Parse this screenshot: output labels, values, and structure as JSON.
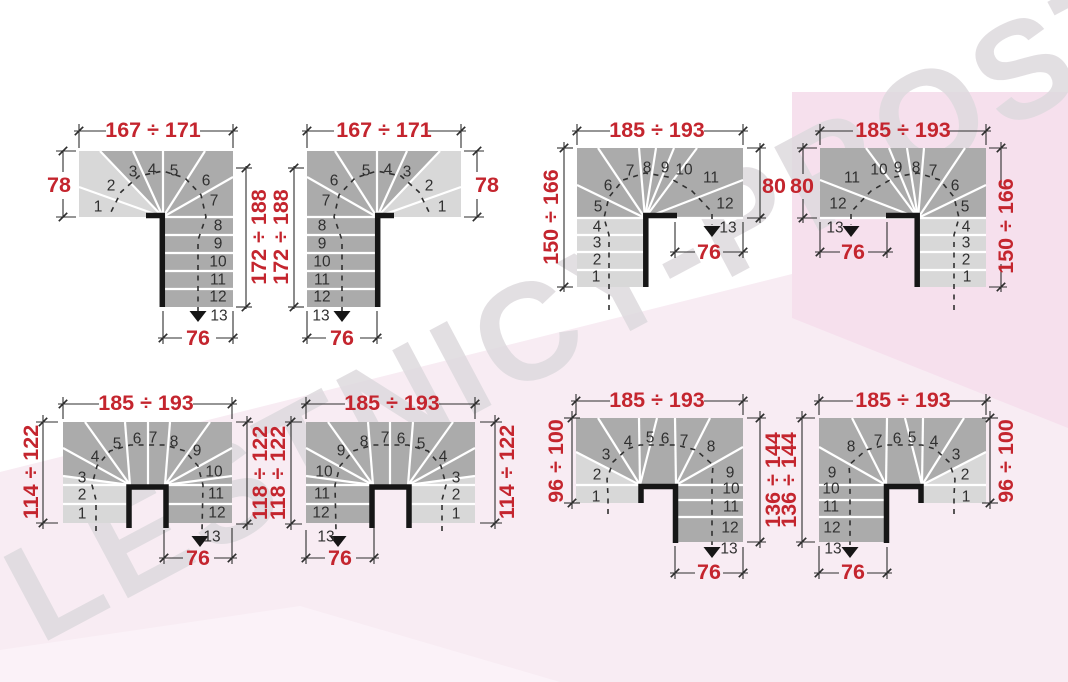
{
  "watermark": "LESTNICY-PROSTO.RU",
  "step_numbers": [
    "1",
    "2",
    "3",
    "4",
    "5",
    "6",
    "7",
    "8",
    "9",
    "10",
    "11",
    "12",
    "13"
  ],
  "diagrams": [
    {
      "name": "top-left-winder-left-turn",
      "dims": {
        "top": "167 ÷ 171",
        "left": "78",
        "right": "172 ÷ 188",
        "bottom": "76"
      }
    },
    {
      "name": "top-second-winder-right-turn",
      "dims": {
        "top": "167 ÷ 171",
        "left": "172 ÷ 188",
        "right": "78",
        "bottom": "76"
      }
    },
    {
      "name": "top-third-winder-up-right",
      "dims": {
        "top": "185 ÷ 193",
        "left": "150 ÷ 166",
        "right": "80",
        "bottom": "76"
      }
    },
    {
      "name": "top-fourth-winder-up-left",
      "dims": {
        "top": "185 ÷ 193",
        "left": "80",
        "right": "150 ÷ 166",
        "bottom": "76"
      }
    },
    {
      "name": "bottom-left-u-turn",
      "dims": {
        "top": "185 ÷ 193",
        "left": "114 ÷ 122",
        "right": "118 ÷ 122",
        "bottom": "76"
      }
    },
    {
      "name": "bottom-second-u-turn-mirrored",
      "dims": {
        "top": "185 ÷ 193",
        "left": "118 ÷ 122",
        "right": "114 ÷ 122",
        "bottom": "76"
      }
    },
    {
      "name": "bottom-third-u-turn-offset",
      "dims": {
        "top": "185 ÷ 193",
        "left": "96 ÷ 100",
        "right": "136 ÷ 144",
        "bottom": "76"
      }
    },
    {
      "name": "bottom-fourth-u-turn-offset",
      "dims": {
        "top": "185 ÷ 193",
        "left": "136 ÷ 144",
        "right": "96 ÷ 100",
        "bottom": "76"
      }
    }
  ],
  "colors": {
    "dimension_red": "#c4252e",
    "step_dark": "#ababab",
    "step_light": "#d8d8d8",
    "step_divider_white": "#ffffff",
    "outline_black": "#2e2e2e",
    "stringer_black": "#161616",
    "number_gray": "#303030",
    "background_white": "#ffffff",
    "background_pink": "#f8ecf3",
    "background_pink_deep": "#f6e0ed",
    "background_pink_soft": "#fbf2f8",
    "watermark_gray": "#dedade"
  }
}
